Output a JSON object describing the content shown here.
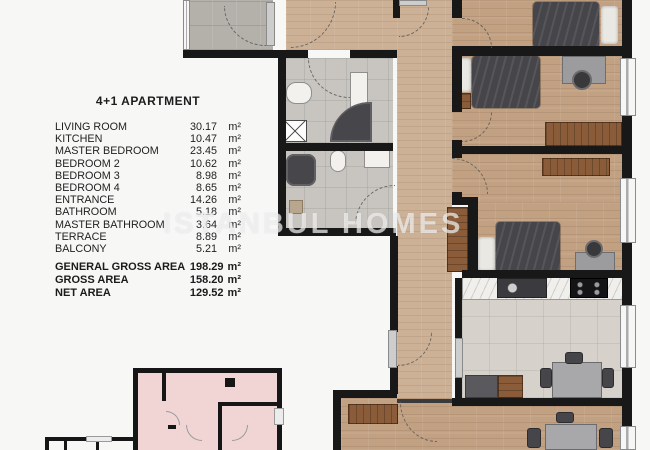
{
  "legend": {
    "title": "4+1 APARTMENT",
    "rooms": [
      {
        "label": "LIVING ROOM",
        "value": "30.17",
        "unit": "m²"
      },
      {
        "label": "KITCHEN",
        "value": "10.47",
        "unit": "m²"
      },
      {
        "label": "MASTER BEDROOM",
        "value": "23.45",
        "unit": "m²"
      },
      {
        "label": "BEDROOM 2",
        "value": "10.62",
        "unit": "m²"
      },
      {
        "label": "BEDROOM 3",
        "value": "8.98",
        "unit": "m²"
      },
      {
        "label": "BEDROOM 4",
        "value": "8.65",
        "unit": "m²"
      },
      {
        "label": "ENTRANCE",
        "value": "14.26",
        "unit": "m²"
      },
      {
        "label": "BATHROOM",
        "value": "5.18",
        "unit": "m²"
      },
      {
        "label": "MASTER BATHROOM",
        "value": "3.64",
        "unit": "m²"
      },
      {
        "label": "TERRACE",
        "value": "8.89",
        "unit": "m²"
      },
      {
        "label": "BALCONY",
        "value": "5.21",
        "unit": "m²"
      }
    ],
    "summary": [
      {
        "label": "GENERAL GROSS AREA",
        "value": "198.29",
        "unit": "m²"
      },
      {
        "label": "GROSS AREA",
        "value": "158.20",
        "unit": "m²"
      },
      {
        "label": "NET AREA",
        "value": "129.52",
        "unit": "m²"
      }
    ]
  },
  "watermark": "ISTANBUL HOMES",
  "colors": {
    "wall": "#181818",
    "wood_floor": "#c2a183",
    "light_wood_floor": "#ccb196",
    "bath_tile": "#c8c5c0",
    "kitchen_tile": "#d6d2cb",
    "terrace_tile": "#b4b1ab",
    "wardrobe_wood": "#8a5c39",
    "keyplan_pink": "#f1d5d5",
    "watermark_white": "rgba(255,255,255,0.62)",
    "background": "#f7f7f6"
  }
}
